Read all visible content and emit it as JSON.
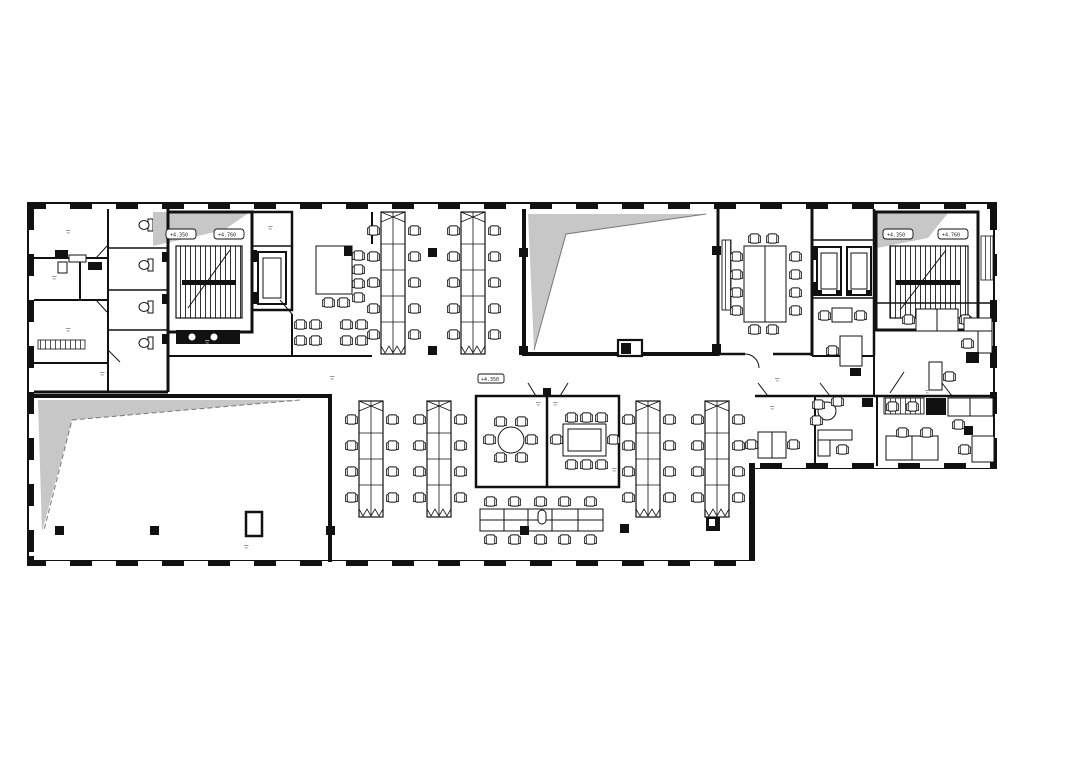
{
  "document": {
    "type": "architectural-floor-plan",
    "style": "black and white CAD office plan with shaded voids"
  },
  "colors": {
    "ink": "#111111",
    "paper": "#ffffff",
    "shade": "#c7c7c7"
  },
  "labels": {
    "stair_west_tag_a": "+4.350",
    "stair_west_tag_b": "+4.760",
    "stair_east_tag_a": "+4.350",
    "stair_east_tag_b": "+4.760",
    "floor_level_tag": "+4.350"
  },
  "areas": [
    {
      "id": "offices-west",
      "kind": "cellular-offices"
    },
    {
      "id": "wc-block-west",
      "kind": "toilet-stalls"
    },
    {
      "id": "stair-west",
      "kind": "staircase"
    },
    {
      "id": "lift-west",
      "kind": "elevator-shaft"
    },
    {
      "id": "kitchen-breakout",
      "kind": "kitchen-island-and-lounge"
    },
    {
      "id": "open-office-north",
      "kind": "two-double-desk-benches"
    },
    {
      "id": "void-north",
      "kind": "double-height-void"
    },
    {
      "id": "conference-room",
      "kind": "meeting-room-12-seats"
    },
    {
      "id": "lift-lobby-east",
      "kind": "elevator-pair"
    },
    {
      "id": "stair-east",
      "kind": "staircase"
    },
    {
      "id": "office-northeast",
      "kind": "open-office-desks"
    },
    {
      "id": "offices-southeast",
      "kind": "three-cellular-offices"
    },
    {
      "id": "void-south",
      "kind": "double-height-void"
    },
    {
      "id": "open-office-south",
      "kind": "four-desk-benches-and-hot-desk-row"
    },
    {
      "id": "meeting-room-round",
      "kind": "meeting-room-6-seats"
    },
    {
      "id": "meeting-room-rect",
      "kind": "meeting-room-8-seats"
    }
  ]
}
